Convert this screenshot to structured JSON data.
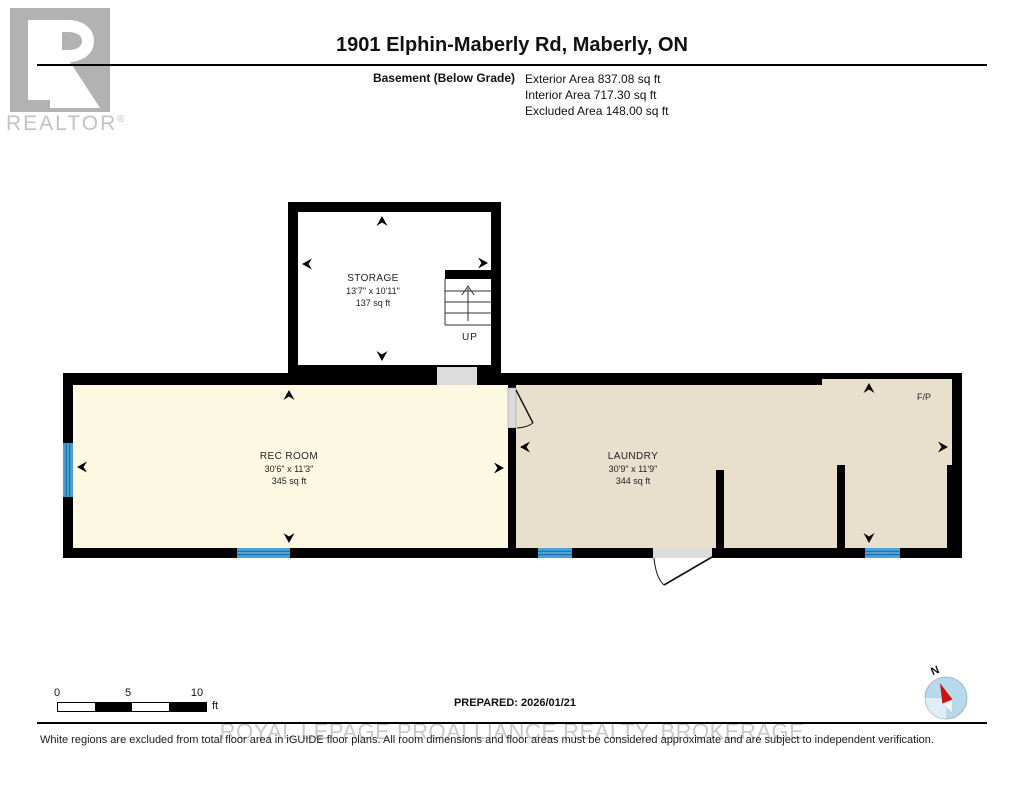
{
  "logo": {
    "brand": "REALTOR",
    "registered_mark": "®"
  },
  "header": {
    "title": "1901 Elphin-Maberly Rd, Maberly, ON",
    "floor_label": "Basement (Below Grade)",
    "area_lines": [
      "Exterior Area 837.08 sq ft",
      "Interior Area 717.30 sq ft",
      "Excluded Area 148.00 sq ft"
    ]
  },
  "rooms": [
    {
      "name": "STORAGE",
      "dimensions": "13'7\" x 10'11\"",
      "area": "137 sq ft"
    },
    {
      "name": "REC ROOM",
      "dimensions": "30'6\" x 11'3\"",
      "area": "345 sq ft"
    },
    {
      "name": "LAUNDRY",
      "dimensions": "30'9\" x 11'9\"",
      "area": "344 sq ft"
    }
  ],
  "plan_labels": {
    "stairs": "UP",
    "fireplace": "F/P",
    "compass": "N"
  },
  "scale_bar": {
    "ticks": [
      "0",
      "5",
      "10"
    ],
    "unit": "ft"
  },
  "footer": {
    "prepared": "PREPARED: 2026/01/21",
    "watermark": "ROYAL LEPAGE PROALLIANCE REALTY, BROKERAGE",
    "disclaimer": "White regions are excluded from total floor area in iGUIDE floor plans. All room dimensions and floor areas must be considered approximate and are subject to independent verification."
  },
  "colors": {
    "wall": "#000000",
    "rec_room_fill": "#FDF8E2",
    "laundry_fill": "#E8E0CD",
    "excluded_fill": "#FFFFFF",
    "window_blue": "#4AA3D4",
    "opening_gray": "#DCDCDC",
    "watermark_gray": "#C9C9C9",
    "compass_blue": "#B7D9EC",
    "compass_needle_red": "#CC1111"
  }
}
